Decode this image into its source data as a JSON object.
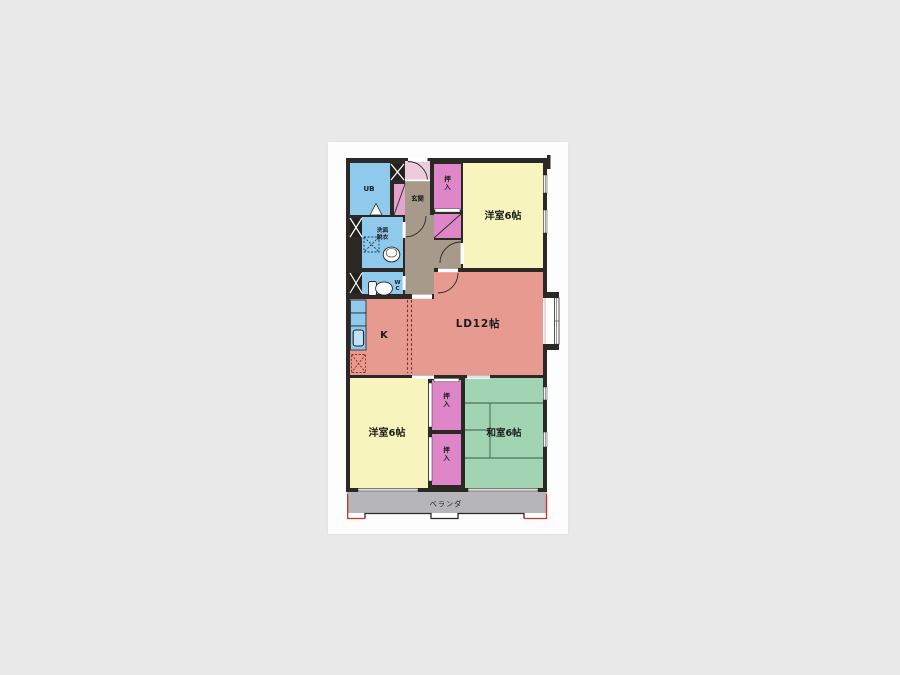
{
  "canvas": {
    "background": "#e9e9ea",
    "paper": "#fdfdfd"
  },
  "plan": {
    "type": "apartment-floor-plan",
    "wall_color": "#2b2826",
    "tatami_line": "#3a5a46",
    "accent_red": "#cc3326",
    "misc": {
      "door_swing_color": "#eccbdb",
      "shoe_closet_color": "#e2a3cf",
      "closet_front_white": "#ffffff",
      "kitchen_sink_inner": "#bfe2f4"
    },
    "rooms": [
      {
        "id": "ub",
        "label": "UB",
        "color": "#8fc9eb"
      },
      {
        "id": "genkan",
        "label": "玄関",
        "color": "#a89a8b"
      },
      {
        "id": "oshiire-north",
        "label": "押入",
        "color": "#df86c8"
      },
      {
        "id": "yoshitsu-north",
        "label": "洋室6帖",
        "color": "#f8f4bd"
      },
      {
        "id": "senmen-datsui",
        "label": "洗面脱衣",
        "line1": "洗面",
        "line2": "脱衣",
        "color": "#8fc9eb"
      },
      {
        "id": "wc",
        "label": "WC",
        "color": "#8fc9eb"
      },
      {
        "id": "hall",
        "label": "",
        "color": "#a89a8b"
      },
      {
        "id": "kitchen",
        "label": "K",
        "color": "#e79b90"
      },
      {
        "id": "living-dining",
        "label": "LD12帖",
        "color": "#e79b90"
      },
      {
        "id": "yoshitsu-south",
        "label": "洋室6帖",
        "color": "#f8f4bd"
      },
      {
        "id": "oshiire-south-upper",
        "label": "押入",
        "color": "#df86c8"
      },
      {
        "id": "oshiire-south-lower",
        "label": "押入",
        "color": "#df86c8"
      },
      {
        "id": "washitsu",
        "label": "和室6帖",
        "color": "#a0d4b2"
      },
      {
        "id": "veranda",
        "label": "ベランダ",
        "color": "#b6b6ba"
      }
    ],
    "fixtures": [
      "entrance-door",
      "unit-bath-door",
      "washing-machine",
      "wash-basin",
      "toilet",
      "kitchen-counter",
      "kitchen-sink",
      "stove",
      "bay-window",
      "pillar",
      "tatami-grid",
      "sliding-door",
      "balcony-railing"
    ]
  }
}
